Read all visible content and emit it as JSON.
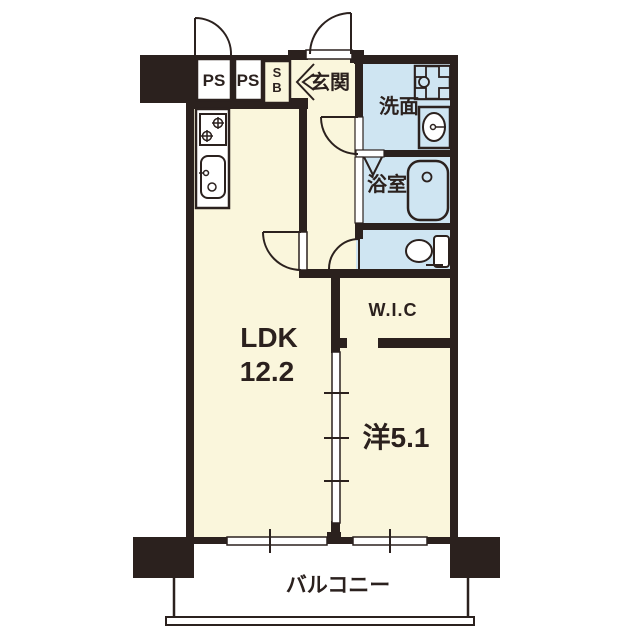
{
  "colors": {
    "wall": "#2B211E",
    "room_floor": "#FAF6DC",
    "wet_area_floor": "#CFE5F2",
    "background": "#FFFFFF"
  },
  "rooms": {
    "ps1": {
      "label": "PS"
    },
    "ps2": {
      "label": "PS"
    },
    "shoe_box": {
      "line1": "S",
      "line2": "B"
    },
    "entrance": {
      "label": "玄関"
    },
    "washroom": {
      "label": "洗面"
    },
    "bathroom": {
      "label": "浴室"
    },
    "wic": {
      "label": "W.I.C"
    },
    "ldk": {
      "name": "LDK",
      "size": "12.2"
    },
    "western_room": {
      "label": "洋5.1"
    },
    "balcony": {
      "label": "バルコニー"
    }
  },
  "fixtures": [
    "stove-icon",
    "kitchen-sink-icon",
    "laundry-pan-icon",
    "vanity-sink-icon",
    "bathtub-icon",
    "toilet-icon"
  ]
}
